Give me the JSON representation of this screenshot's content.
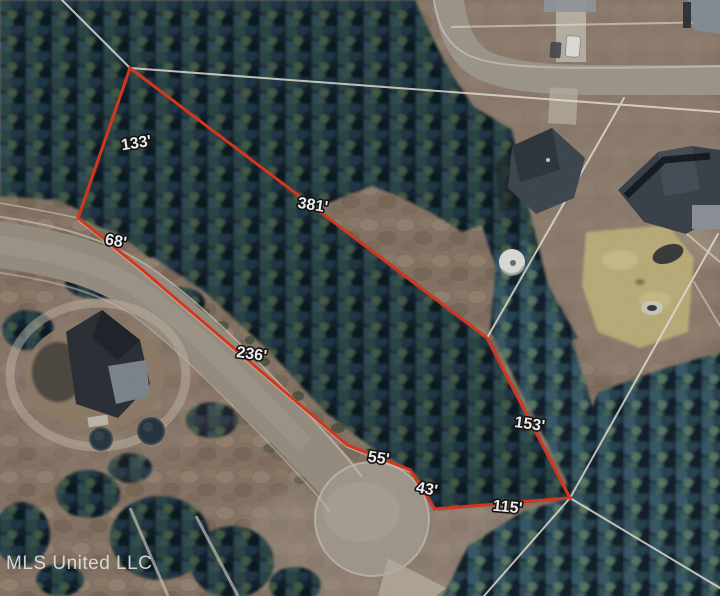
{
  "boundary": {
    "stroke_color": "#e63b20",
    "vertices": [
      {
        "x": 130,
        "y": 68
      },
      {
        "x": 487,
        "y": 338
      },
      {
        "x": 570,
        "y": 498
      },
      {
        "x": 435,
        "y": 509
      },
      {
        "x": 410,
        "y": 470
      },
      {
        "x": 347,
        "y": 445
      },
      {
        "x": 140,
        "y": 268
      },
      {
        "x": 78,
        "y": 218
      }
    ],
    "labels": [
      {
        "label": "381'",
        "x": 312,
        "y": 210,
        "rot": 9
      },
      {
        "label": "153'",
        "x": 529,
        "y": 429,
        "rot": 8
      },
      {
        "label": "115'",
        "x": 507,
        "y": 512,
        "rot": 6
      },
      {
        "label": "43'",
        "x": 426,
        "y": 494,
        "rot": 10
      },
      {
        "label": "55'",
        "x": 378,
        "y": 463,
        "rot": 8
      },
      {
        "label": "236'",
        "x": 251,
        "y": 359,
        "rot": 8
      },
      {
        "label": "68'",
        "x": 115,
        "y": 246,
        "rot": 10
      },
      {
        "label": "133'",
        "x": 137,
        "y": 148,
        "rot": -9
      }
    ]
  },
  "watermark": {
    "text": "MLS United LLC"
  },
  "colors": {
    "boundary": "#e63b20",
    "parcel_line": "#f2eee1",
    "label_text": "#ffffff",
    "label_outline": "#161616",
    "watermark": "#e3e3e3"
  }
}
